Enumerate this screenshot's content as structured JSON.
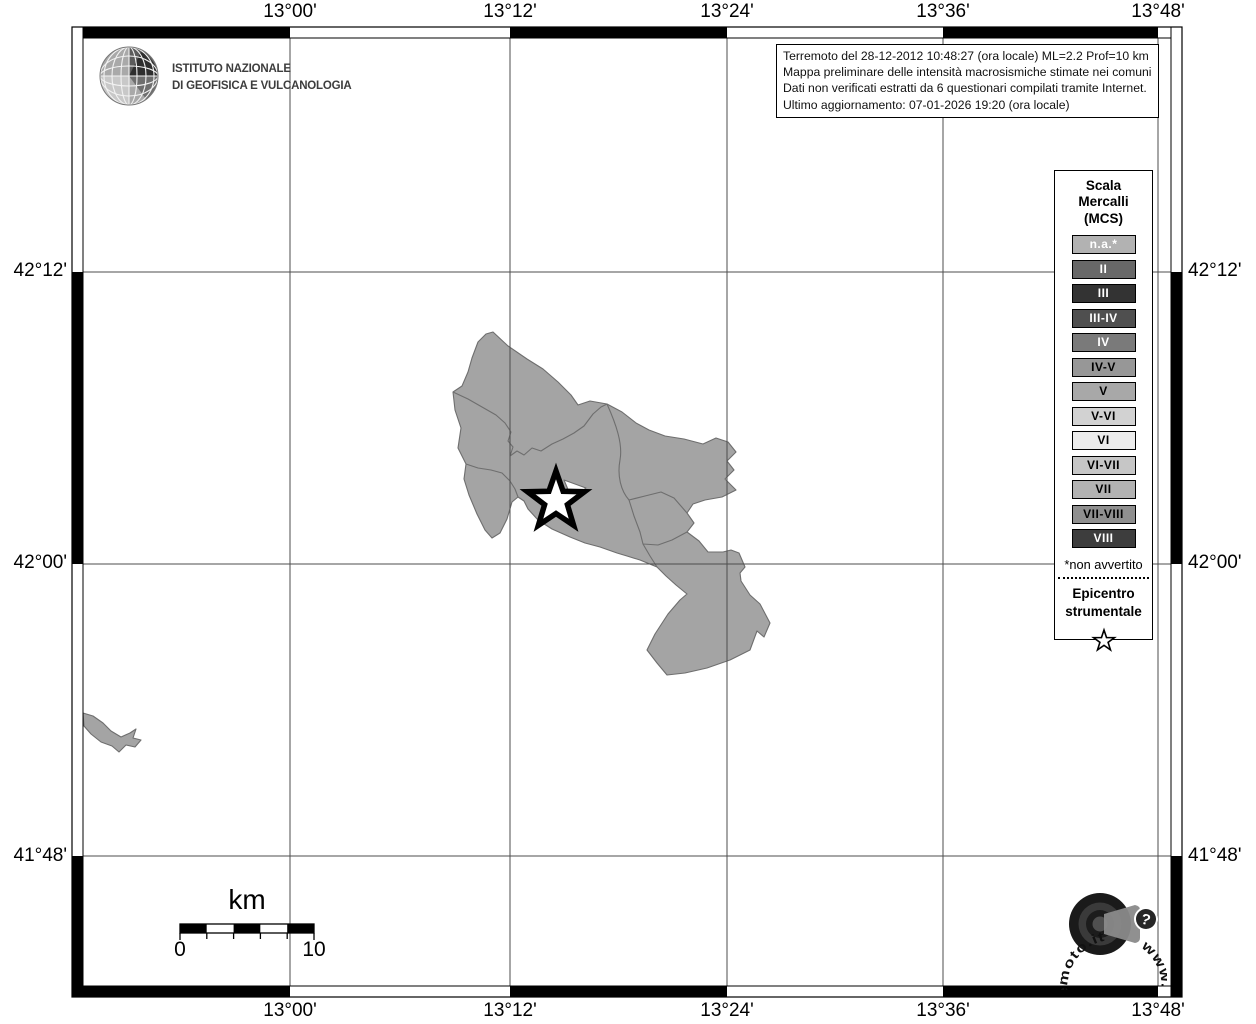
{
  "header": {
    "ingv_name": "ISTITUTO NAZIONALE\nDI GEOFISICA E VULCANOLOGIA",
    "info_box": {
      "line1": "Terremoto del 28-12-2012 10:48:27 (ora locale) ML=2.2 Prof=10 km",
      "line2": "Mappa preliminare delle intensità macrosismiche stimate nei comuni",
      "line3": "Dati non verificati estratti da 6 questionari compilati tramite Internet.",
      "line4": "Ultimo aggiornamento: 07-01-2026 19:20 (ora locale)"
    }
  },
  "axes": {
    "lon_labels": [
      "13°00'",
      "13°12'",
      "13°24'",
      "13°36'",
      "13°48'"
    ],
    "lat_labels": [
      "42°12'",
      "42°00'",
      "41°48'"
    ]
  },
  "legend": {
    "title": "Scala\nMercalli\n(MCS)",
    "items": [
      {
        "label": "n.a.*",
        "color": "#b2b2b2",
        "text": "#ffffff"
      },
      {
        "label": "II",
        "color": "#686868",
        "text": "#ffffff"
      },
      {
        "label": "III",
        "color": "#333333",
        "text": "#ffffff"
      },
      {
        "label": "III-IV",
        "color": "#4f4f4f",
        "text": "#ffffff"
      },
      {
        "label": "IV",
        "color": "#7a7a7a",
        "text": "#ffffff"
      },
      {
        "label": "IV-V",
        "color": "#979797",
        "text": "#000000"
      },
      {
        "label": "V",
        "color": "#a8a8a8",
        "text": "#000000"
      },
      {
        "label": "V-VI",
        "color": "#d2d2d2",
        "text": "#000000"
      },
      {
        "label": "VI",
        "color": "#ececec",
        "text": "#000000"
      },
      {
        "label": "VI-VII",
        "color": "#c6c6c6",
        "text": "#000000"
      },
      {
        "label": "VII",
        "color": "#b2b2b2",
        "text": "#000000"
      },
      {
        "label": "VII-VIII",
        "color": "#8f8f8f",
        "text": "#000000"
      },
      {
        "label": "VIII",
        "color": "#3d3d3d",
        "text": "#ffffff"
      }
    ],
    "footnote": "*non avvertito",
    "epicenter_label": "Epicentro\nstrumentale"
  },
  "map": {
    "municipality_fill": "#a4a4a4",
    "municipality_border": "#6e6e6e",
    "epicenter_star": {
      "fill": "#ffffff",
      "stroke": "#000000"
    }
  },
  "scale_bar": {
    "unit": "km",
    "start": "0",
    "end": "10"
  },
  "footer_logo": {
    "url_text": "www.haisentitoilterremoto.it",
    "question_mark": "?"
  }
}
